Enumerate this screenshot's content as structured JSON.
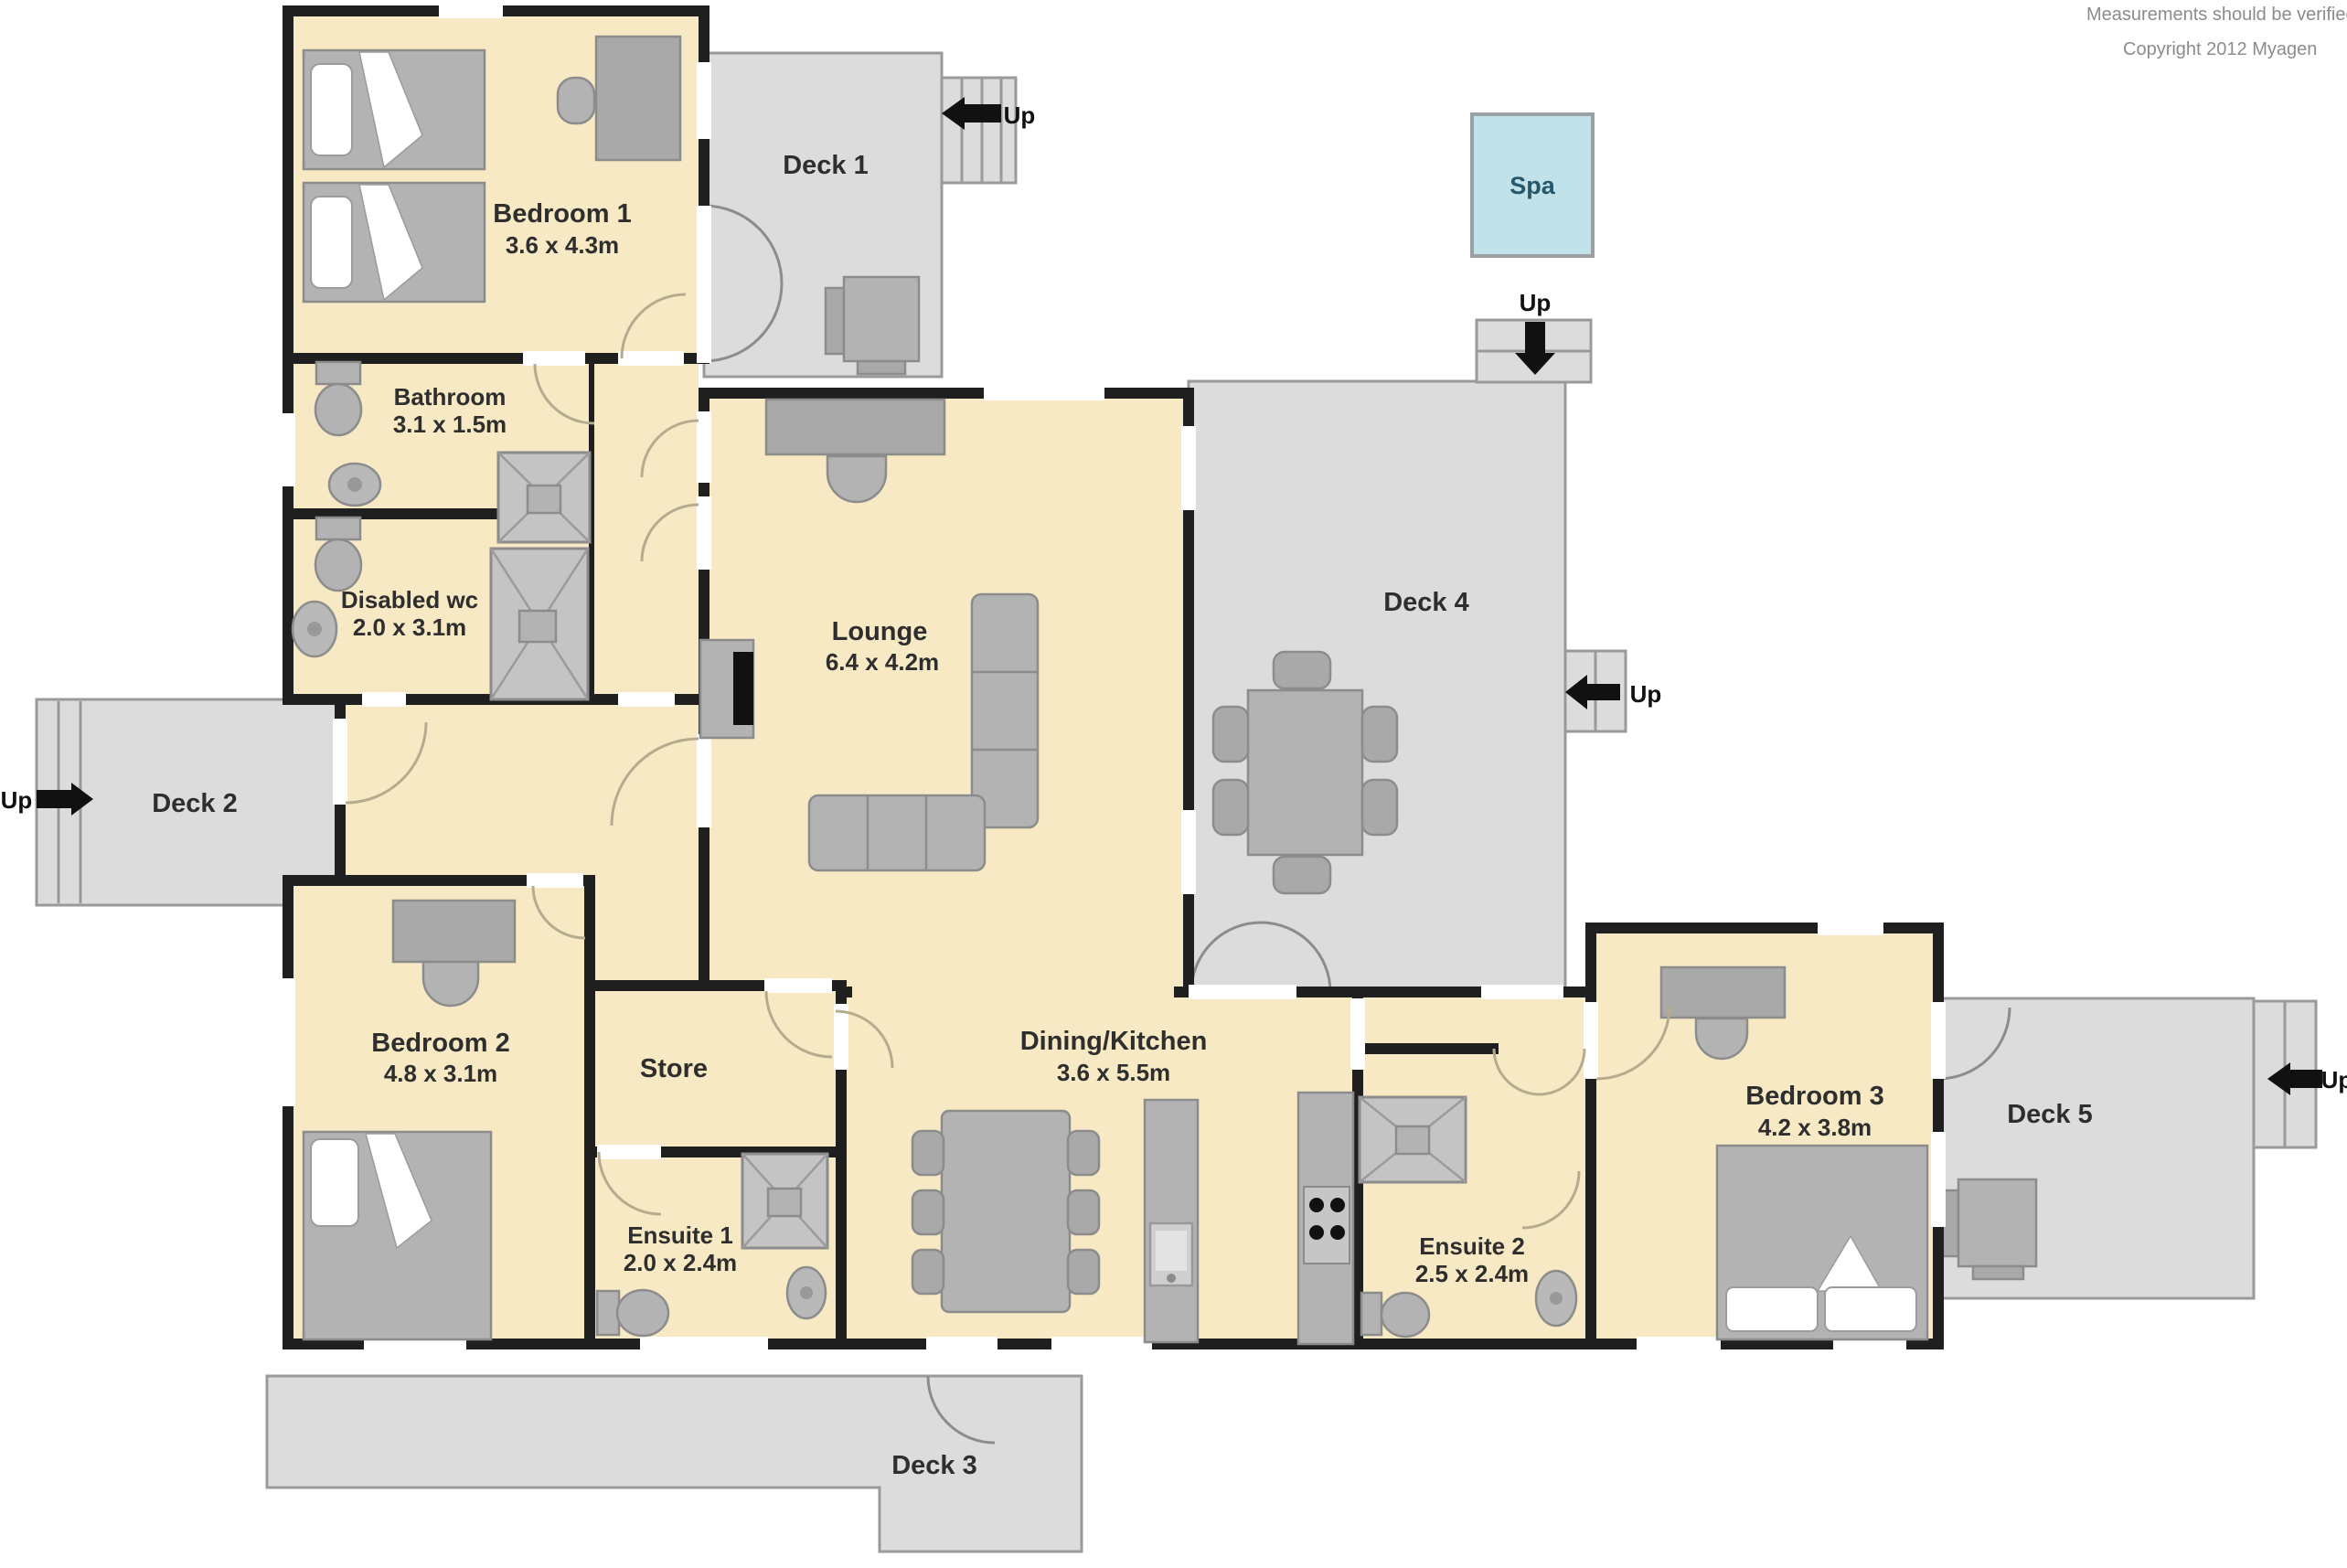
{
  "notes": {
    "line1": "Measurements should be verified b",
    "line2": "Copyright 2012      Myagen"
  },
  "rooms": {
    "bedroom1": {
      "name": "Bedroom 1",
      "dims": "3.6 x 4.3m"
    },
    "bathroom": {
      "name": "Bathroom",
      "dims": "3.1 x 1.5m"
    },
    "disabled_wc": {
      "name": "Disabled wc",
      "dims": "2.0 x 3.1m"
    },
    "lounge": {
      "name": "Lounge",
      "dims": "6.4 x 4.2m"
    },
    "bedroom2": {
      "name": "Bedroom 2",
      "dims": "4.8 x 3.1m"
    },
    "store": {
      "name": "Store"
    },
    "ensuite1": {
      "name": "Ensuite 1",
      "dims": "2.0 x 2.4m"
    },
    "dining_kitchen": {
      "name": "Dining/Kitchen",
      "dims": "3.6 x 5.5m"
    },
    "ensuite2": {
      "name": "Ensuite 2",
      "dims": "2.5 x 2.4m"
    },
    "bedroom3": {
      "name": "Bedroom 3",
      "dims": "4.2 x 3.8m"
    }
  },
  "decks": {
    "deck1": {
      "label": "Deck 1"
    },
    "deck2": {
      "label": "Deck 2"
    },
    "deck3": {
      "label": "Deck 3"
    },
    "deck4": {
      "label": "Deck 4"
    },
    "deck5": {
      "label": "Deck 5"
    }
  },
  "spa": {
    "label": "Spa"
  },
  "stairs": {
    "deck1": "Up",
    "deck2": "Up",
    "deck4_top": "Up",
    "deck4_right": "Up",
    "deck5": "Up"
  },
  "colors": {
    "room_fill": "#f6e9c4",
    "deck_fill": "#dcdcdc",
    "deck_border": "#9a9a9a",
    "wall": "#1f1f1f",
    "spa_fill": "#c2e2ea",
    "furniture": "#b3b3b3",
    "label_text": "#2e2e2e"
  }
}
